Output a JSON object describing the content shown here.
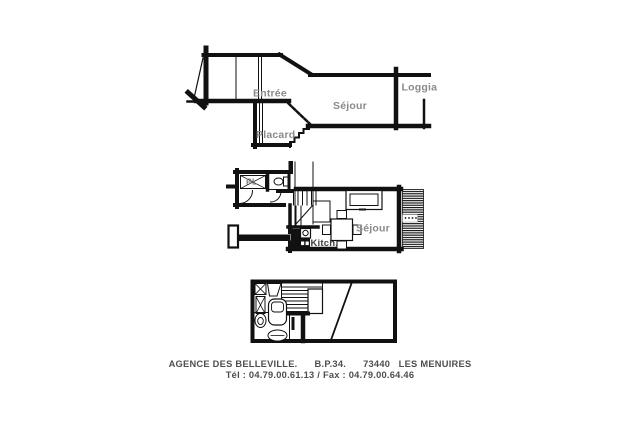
{
  "page": {
    "background_color": "#ffffff"
  },
  "colors": {
    "line": "#111111",
    "label_gray": "#8a8a8a",
    "label_dark": "#3d3d3d",
    "footer_text": "#4e4e4e"
  },
  "upper_section": {
    "labels": {
      "entree": "Entrée",
      "sejour": "Séjour",
      "loggia": "Loggia",
      "placard": "Placard"
    }
  },
  "main_plan": {
    "labels": {
      "closet": "PL",
      "kitchen": "Kitch.",
      "living": "Séjour"
    }
  },
  "footer": {
    "line1": "AGENCE DES BELLEVILLE.      B.P.34.      73440   LES MENUIRES",
    "line2": "Tél : 04.79.00.61.13 / Fax : 04.79.00.64.46"
  }
}
